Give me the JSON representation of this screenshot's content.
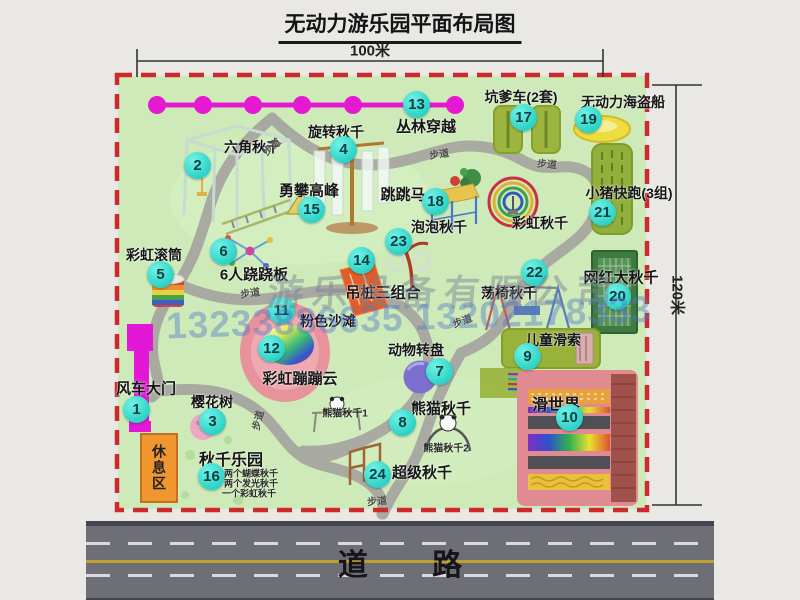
{
  "title": "无动力游乐园平面布局图",
  "dimensions": {
    "width": "100米",
    "height": "120米"
  },
  "road": {
    "label": "道 路"
  },
  "rest_area": {
    "label": "休息区"
  },
  "watermark": {
    "company": "游乐设备有限公司",
    "phone": "13233886635 13202178333"
  },
  "walkway_label": "步道",
  "walkway_labels": [
    {
      "x": 271,
      "y": 146,
      "r": -42
    },
    {
      "x": 439,
      "y": 153,
      "r": -8
    },
    {
      "x": 547,
      "y": 163,
      "r": 5
    },
    {
      "x": 250,
      "y": 292,
      "r": -8
    },
    {
      "x": 462,
      "y": 320,
      "r": -20
    },
    {
      "x": 257,
      "y": 420,
      "r": -75
    },
    {
      "x": 377,
      "y": 500,
      "r": -5
    }
  ],
  "attractions": [
    {
      "num": "1",
      "name": "风车大门",
      "bx": 137,
      "by": 410,
      "lx": 146,
      "ly": 388,
      "fs": 15
    },
    {
      "num": "2",
      "name": "六角秋千",
      "bx": 198,
      "by": 166,
      "lx": 252,
      "ly": 147
    },
    {
      "num": "3",
      "name": "樱花树",
      "bx": 213,
      "by": 422,
      "lx": 212,
      "ly": 402
    },
    {
      "num": "4",
      "name": "旋转秋千",
      "bx": 344,
      "by": 150,
      "lx": 336,
      "ly": 132
    },
    {
      "num": "5",
      "name": "彩虹滚筒",
      "bx": 161,
      "by": 275,
      "lx": 154,
      "ly": 255
    },
    {
      "num": "6",
      "name": "6人跷跷板",
      "bx": 224,
      "by": 252,
      "lx": 254,
      "ly": 274,
      "fs": 15
    },
    {
      "num": "7",
      "name": "动物转盘",
      "bx": 440,
      "by": 372,
      "lx": 416,
      "ly": 350
    },
    {
      "num": "8",
      "name": "熊猫秋千",
      "bx": 403,
      "by": 423,
      "lx": 441,
      "ly": 408,
      "fs": 15
    },
    {
      "num": "9",
      "name": "儿童滑索",
      "bx": 528,
      "by": 357,
      "lx": 553,
      "ly": 340
    },
    {
      "num": "10",
      "name": "滑世界",
      "bx": 570,
      "by": 418,
      "lx": 556,
      "ly": 403,
      "fs": 16
    },
    {
      "num": "11",
      "name": "粉色沙滩",
      "bx": 282,
      "by": 311,
      "lx": 328,
      "ly": 321
    },
    {
      "num": "12",
      "name": "彩虹蹦蹦云",
      "bx": 272,
      "by": 349,
      "lx": 300,
      "ly": 378,
      "fs": 15
    },
    {
      "num": "13",
      "name": "丛林穿越",
      "bx": 417,
      "by": 105,
      "lx": 426,
      "ly": 126,
      "fs": 15
    },
    {
      "num": "14",
      "name": "吊桩三组合",
      "bx": 362,
      "by": 261,
      "lx": 383,
      "ly": 292,
      "fs": 15
    },
    {
      "num": "15",
      "name": "勇攀高峰",
      "bx": 312,
      "by": 210,
      "lx": 309,
      "ly": 190,
      "fs": 15
    },
    {
      "num": "16",
      "name": "秋千乐园",
      "bx": 212,
      "by": 477,
      "lx": 231,
      "ly": 458,
      "fs": 16
    },
    {
      "num": "17",
      "name": "坑爹车(2套)",
      "bx": 524,
      "by": 118,
      "lx": 521,
      "ly": 97
    },
    {
      "num": "18",
      "name": "跳跳马",
      "bx": 436,
      "by": 202,
      "lx": 403,
      "ly": 194,
      "fs": 15
    },
    {
      "num": "19",
      "name": "无动力海盗船",
      "bx": 589,
      "by": 120,
      "lx": 623,
      "ly": 102
    },
    {
      "num": "20",
      "name": "网红大秋千",
      "bx": 618,
      "by": 297,
      "lx": 621,
      "ly": 277,
      "fs": 15
    },
    {
      "num": "21",
      "name": "小猪快跑(3组)",
      "bx": 603,
      "by": 213,
      "lx": 629,
      "ly": 193
    },
    {
      "num": "22",
      "name": "荡椅秋千",
      "bx": 535,
      "by": 273,
      "lx": 509,
      "ly": 293
    },
    {
      "num": "23",
      "name": "泡泡秋千",
      "bx": 399,
      "by": 242,
      "lx": 439,
      "ly": 227
    },
    {
      "num": "24",
      "name": "超级秋千",
      "bx": 378,
      "by": 475,
      "lx": 422,
      "ly": 472,
      "fs": 15
    }
  ],
  "unnumbered": [
    {
      "name": "彩虹秋千",
      "lx": 540,
      "ly": 223
    }
  ],
  "notes": [
    {
      "text": "熊猫秋千1",
      "x": 345,
      "y": 412,
      "fs": 10
    },
    {
      "text": "熊猫秋千2",
      "x": 446,
      "y": 447,
      "fs": 10
    },
    {
      "text": "两个蝴蝶秋千",
      "x": 251,
      "y": 473,
      "fs": 9
    },
    {
      "text": "两个发光秋千",
      "x": 251,
      "y": 483,
      "fs": 9
    },
    {
      "text": "一个彩虹秋千",
      "x": 249,
      "y": 493,
      "fs": 9
    }
  ],
  "colors": {
    "park_green": "#cdeab8",
    "border_red": "#ce2a2e",
    "badge_cyan": "#2bd2c5",
    "zipline_magenta": "#e619d2",
    "gate_magenta": "#e318d6",
    "rest_orange": "#f0962e",
    "road_gray": "#6e6e76",
    "lane_yellow": "#bfa02c"
  }
}
